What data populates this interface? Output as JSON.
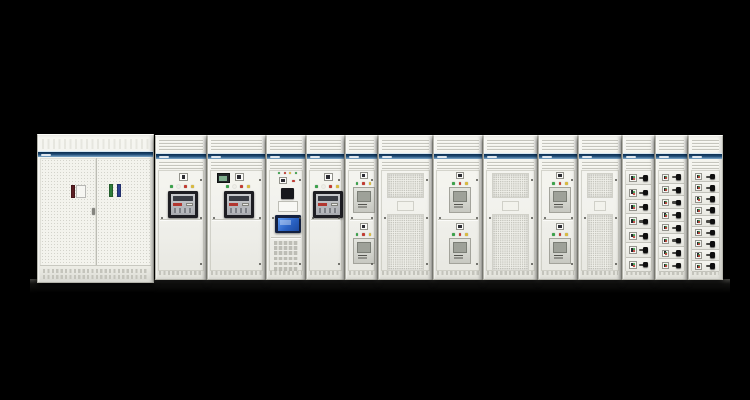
{
  "scene": {
    "description": "Product photograph of a low-voltage electrical switchgear / switchboard lineup on a black background",
    "background": "#000000",
    "palette": {
      "cabinet_face": "#f1f1ec",
      "cabinet_edge": "#b4b4ab",
      "band_top": "#0c2c4d",
      "band_mid": "#1d4a74",
      "band_bottom": "#7fa9cb",
      "led_green": "#3ba24b",
      "led_red": "#c23b32",
      "led_yellow": "#d9ba3e",
      "led_white": "#eeeee8",
      "acb_frame": "#1e1e23",
      "acb_accent": "#b23730",
      "hmi_screen": "#2f6fd8",
      "multimeter_glow": "#7fae8d",
      "handle_black": "#0e0e0e"
    },
    "lineup": {
      "left": 37,
      "top": 134,
      "right": 723,
      "bottom": 284
    },
    "floor_shadow": {
      "x": 30,
      "y": 279,
      "w": 700,
      "h": 14
    }
  },
  "cabinets": [
    {
      "id": "main-incomer",
      "type": "double_door_perforated",
      "x": 37,
      "w": 117,
      "top": 134,
      "h": 149,
      "door_labels": [
        {
          "color": "#5c1e23",
          "x": 31,
          "y": 27,
          "w": 4,
          "h": 13
        },
        {
          "color": "#f6f6f2",
          "x": 36,
          "y": 27,
          "w": 10,
          "h": 13
        },
        {
          "color": "#2e7d3a",
          "x": 69,
          "y": 26,
          "w": 4,
          "h": 13
        },
        {
          "color": "#2c3f8f",
          "x": 77,
          "y": 26,
          "w": 4,
          "h": 13
        }
      ]
    },
    {
      "id": "acb-section-1",
      "type": "acb",
      "x": 155,
      "w": 52
    },
    {
      "id": "acb-section-2",
      "type": "acb_meter",
      "x": 207,
      "w": 59
    },
    {
      "id": "control-section",
      "type": "hmi",
      "x": 266,
      "w": 40,
      "terminal_rows": 6
    },
    {
      "id": "acb-section-3",
      "type": "acb",
      "x": 306,
      "w": 39
    },
    {
      "id": "mccb-section-1",
      "type": "mccb2",
      "x": 345,
      "w": 33,
      "modules": 2
    },
    {
      "id": "vent-section-1",
      "type": "mesh",
      "x": 378,
      "w": 55
    },
    {
      "id": "mccb-section-2",
      "type": "mccb2",
      "x": 433,
      "w": 50,
      "modules": 2
    },
    {
      "id": "vent-section-2",
      "type": "mesh",
      "x": 483,
      "w": 55
    },
    {
      "id": "mccb-section-3",
      "type": "mccb2",
      "x": 538,
      "w": 40,
      "modules": 2
    },
    {
      "id": "vent-section-3",
      "type": "mesh",
      "x": 578,
      "w": 44
    },
    {
      "id": "drawer-section-1",
      "type": "drawers",
      "x": 622,
      "w": 33,
      "drawers": 7,
      "tall": true
    },
    {
      "id": "drawer-section-2",
      "type": "drawers",
      "x": 655,
      "w": 33,
      "drawers": 8,
      "tall": false
    },
    {
      "id": "drawer-section-3",
      "type": "drawers",
      "x": 688,
      "w": 35,
      "drawers": 9,
      "tall": false
    }
  ],
  "acb_indicator_colors": [
    "#3ba24b",
    "#eeeee8",
    "#c23b32",
    "#d9ba3e"
  ],
  "mccb_indicator_colors": [
    "#3ba24b",
    "#c23b32",
    "#d9ba3e"
  ],
  "hmi_indicator_colors": [
    "#3ba24b",
    "#c23b32",
    "#d9ba3e",
    "#3ba24b"
  ]
}
